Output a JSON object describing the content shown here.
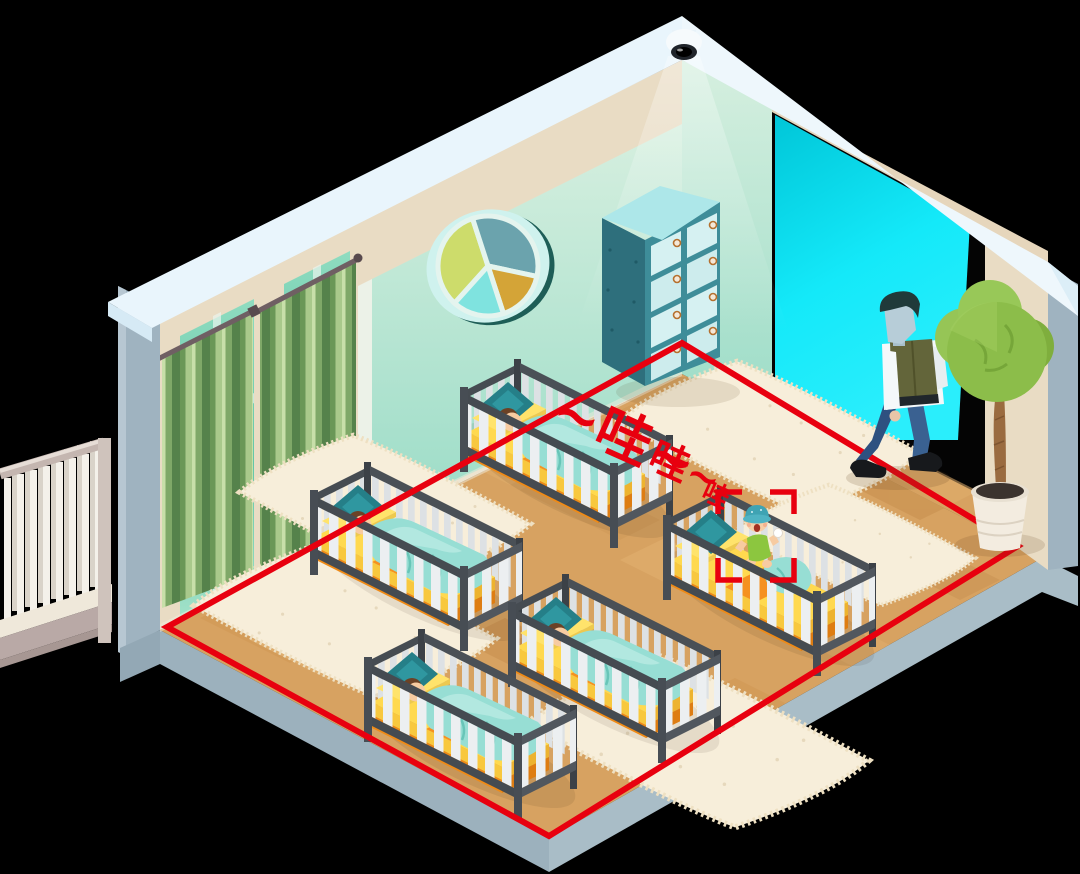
{
  "scene": {
    "crying_sound": {
      "part1": "~哇~",
      "part2": "哇~",
      "part3": "哇"
    },
    "objects": [
      "security-camera",
      "camera-light-beam",
      "detection-zone",
      "focus-bracket",
      "crying-baby",
      "sleeping-baby",
      "crib",
      "rug",
      "storage-cabinet",
      "round-window",
      "curtained-window",
      "doorway-light",
      "caregiver-walking",
      "potted-plant",
      "balcony-railing",
      "wood-floor"
    ],
    "colors": {
      "alert_red": "#e8000f",
      "wall_mint": "#aee2cd",
      "wall_beige": "#e9dcc4",
      "doorway_cyan": "#12e6f7",
      "floor_wood": "#d7a261",
      "floor_edge_gray": "#a9bdc7",
      "crib_frame": "#42474d",
      "mattress_yellow": "#ffd94f",
      "mattress_orange": "#f59120",
      "blanket_teal": "#97ded4",
      "pillow_teal": "#257f88",
      "curtain_green": "#87b06c",
      "cabinet_teal": "#3e8d99",
      "rug_cream": "#f7eeda",
      "plant_green": "#8cbd4a",
      "trim_white": "#eef7fc",
      "skin": "#f7cba1",
      "vest_olive": "#63653a",
      "jeans_blue": "#3a6191"
    }
  }
}
